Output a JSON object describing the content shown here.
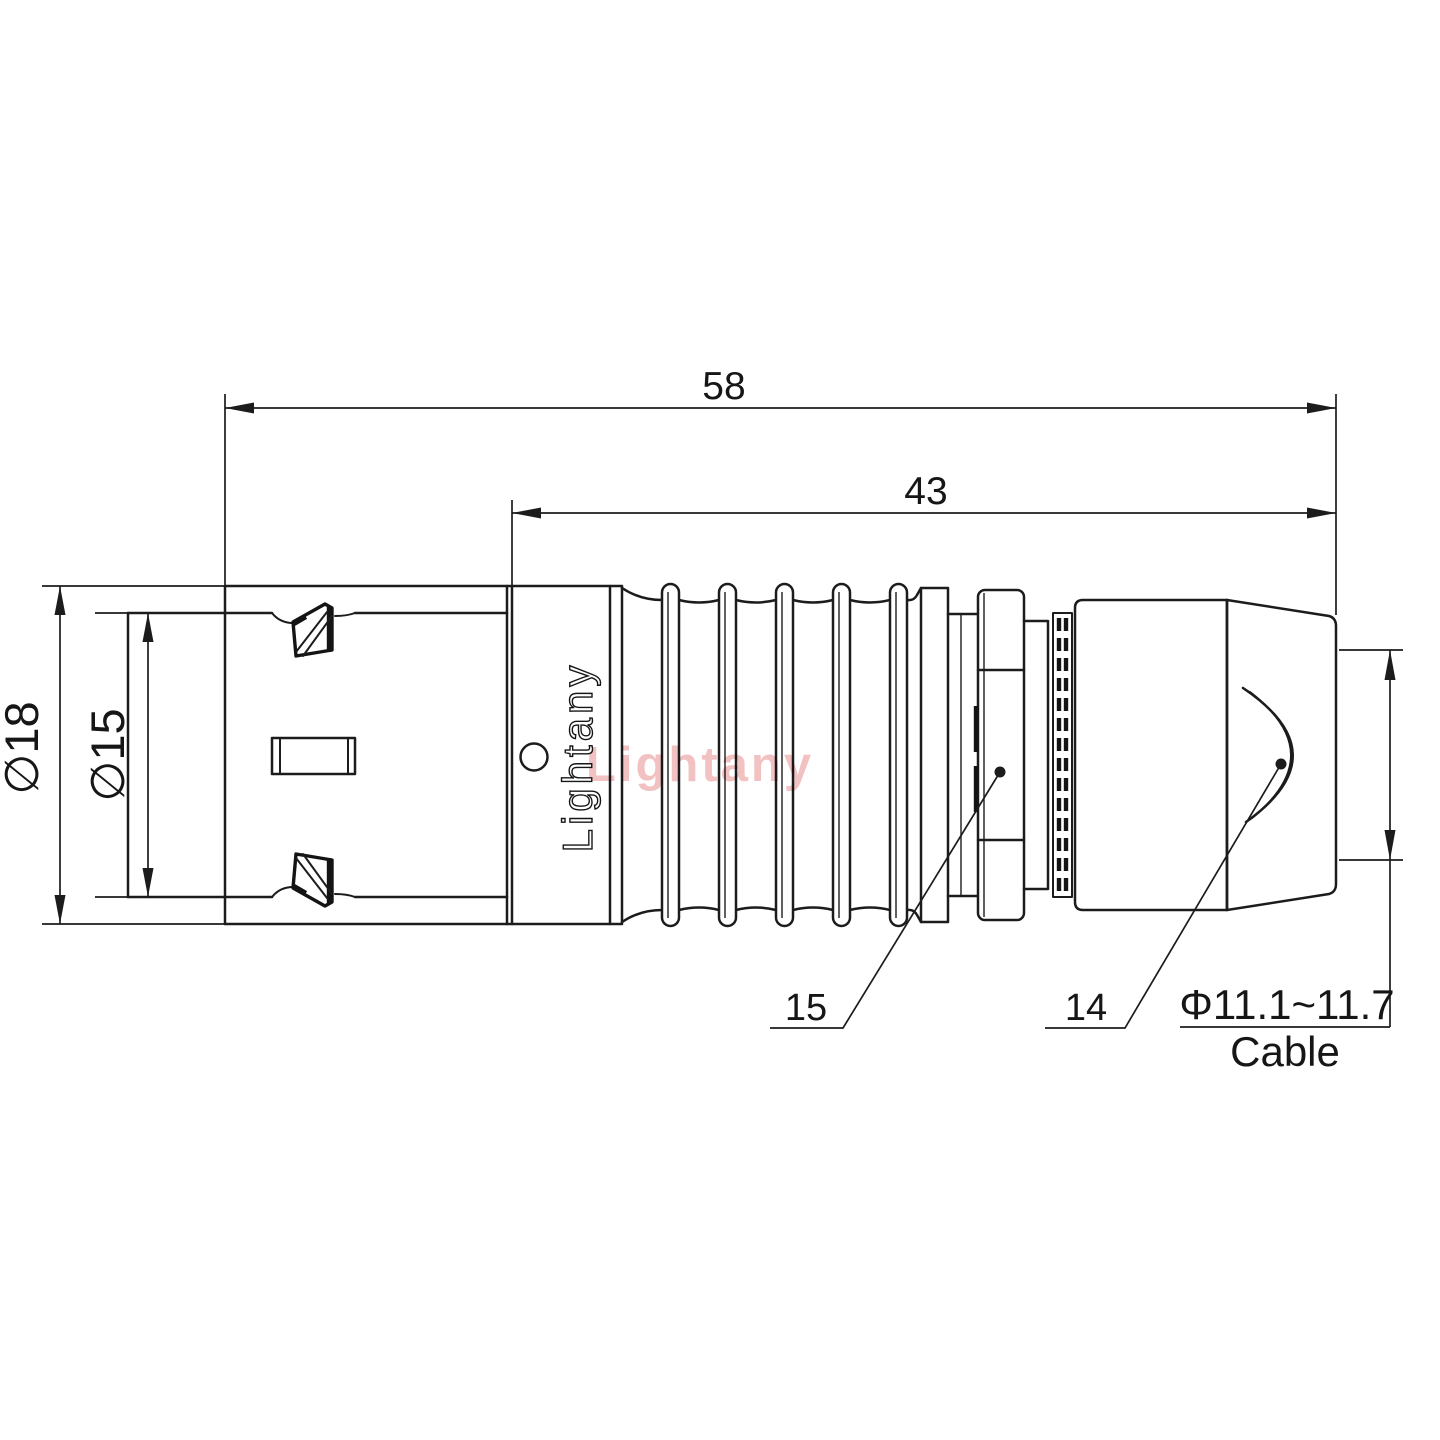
{
  "drawing": {
    "type": "connector engineering drawing, side view",
    "line_color": "#1c1c1c",
    "watermark_text": "Lightany",
    "watermark_color": "#f2c1c1",
    "body_logo_text": "Lightany"
  },
  "dimensions": {
    "total_length": "58",
    "rear_length": "43",
    "outer_diameter": "∅18",
    "coupling_diameter": "∅15",
    "cable_diameter_range": "Φ11.1~11.7",
    "cable_word": "Cable"
  },
  "part_references": {
    "collar_ref": "15",
    "backshell_ref": "14"
  }
}
